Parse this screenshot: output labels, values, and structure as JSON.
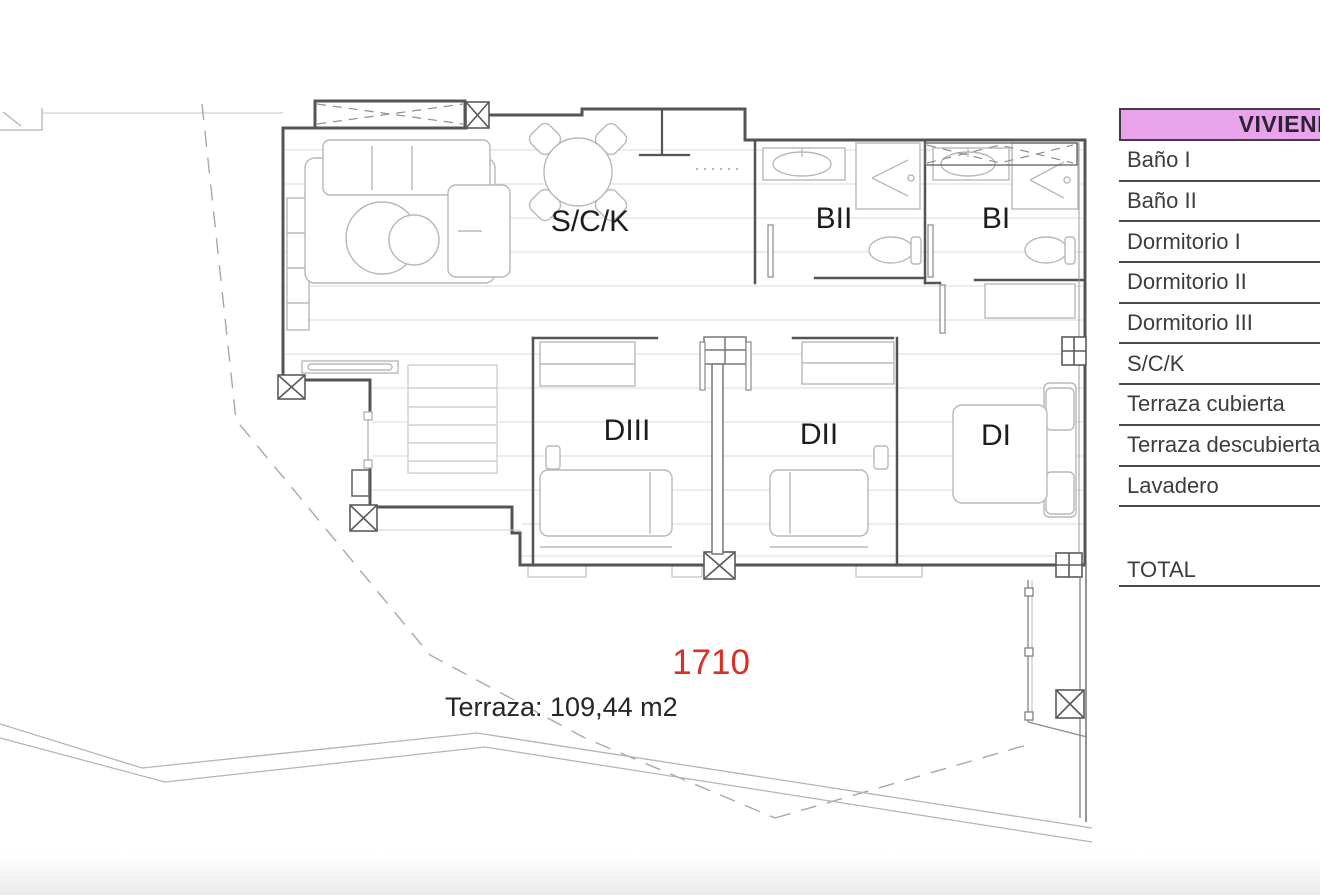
{
  "plan": {
    "unit_number": "1710",
    "terrace_label": "Terraza: 109,44 m2",
    "rooms": {
      "living": "S/C/K",
      "bath2": "BII",
      "bath1": "BI",
      "bed3": "DIII",
      "bed2": "DII",
      "bed1": "DI"
    },
    "colors": {
      "unit_number": "#d93025",
      "wall": "#545454",
      "furniture": "#b8b8b8",
      "floor_line": "#d9d9d9",
      "boundary_dashed": "#a8a8a8"
    }
  },
  "legend": {
    "header": "VIVIENDA",
    "header_bg": "#e9a3ea",
    "rows": [
      "Baño I",
      "Baño II",
      "Dormitorio I",
      "Dormitorio II",
      "Dormitorio III",
      "S/C/K",
      "Terraza cubierta",
      "Terraza descubierta",
      "Lavadero"
    ],
    "total_label": "TOTAL"
  }
}
